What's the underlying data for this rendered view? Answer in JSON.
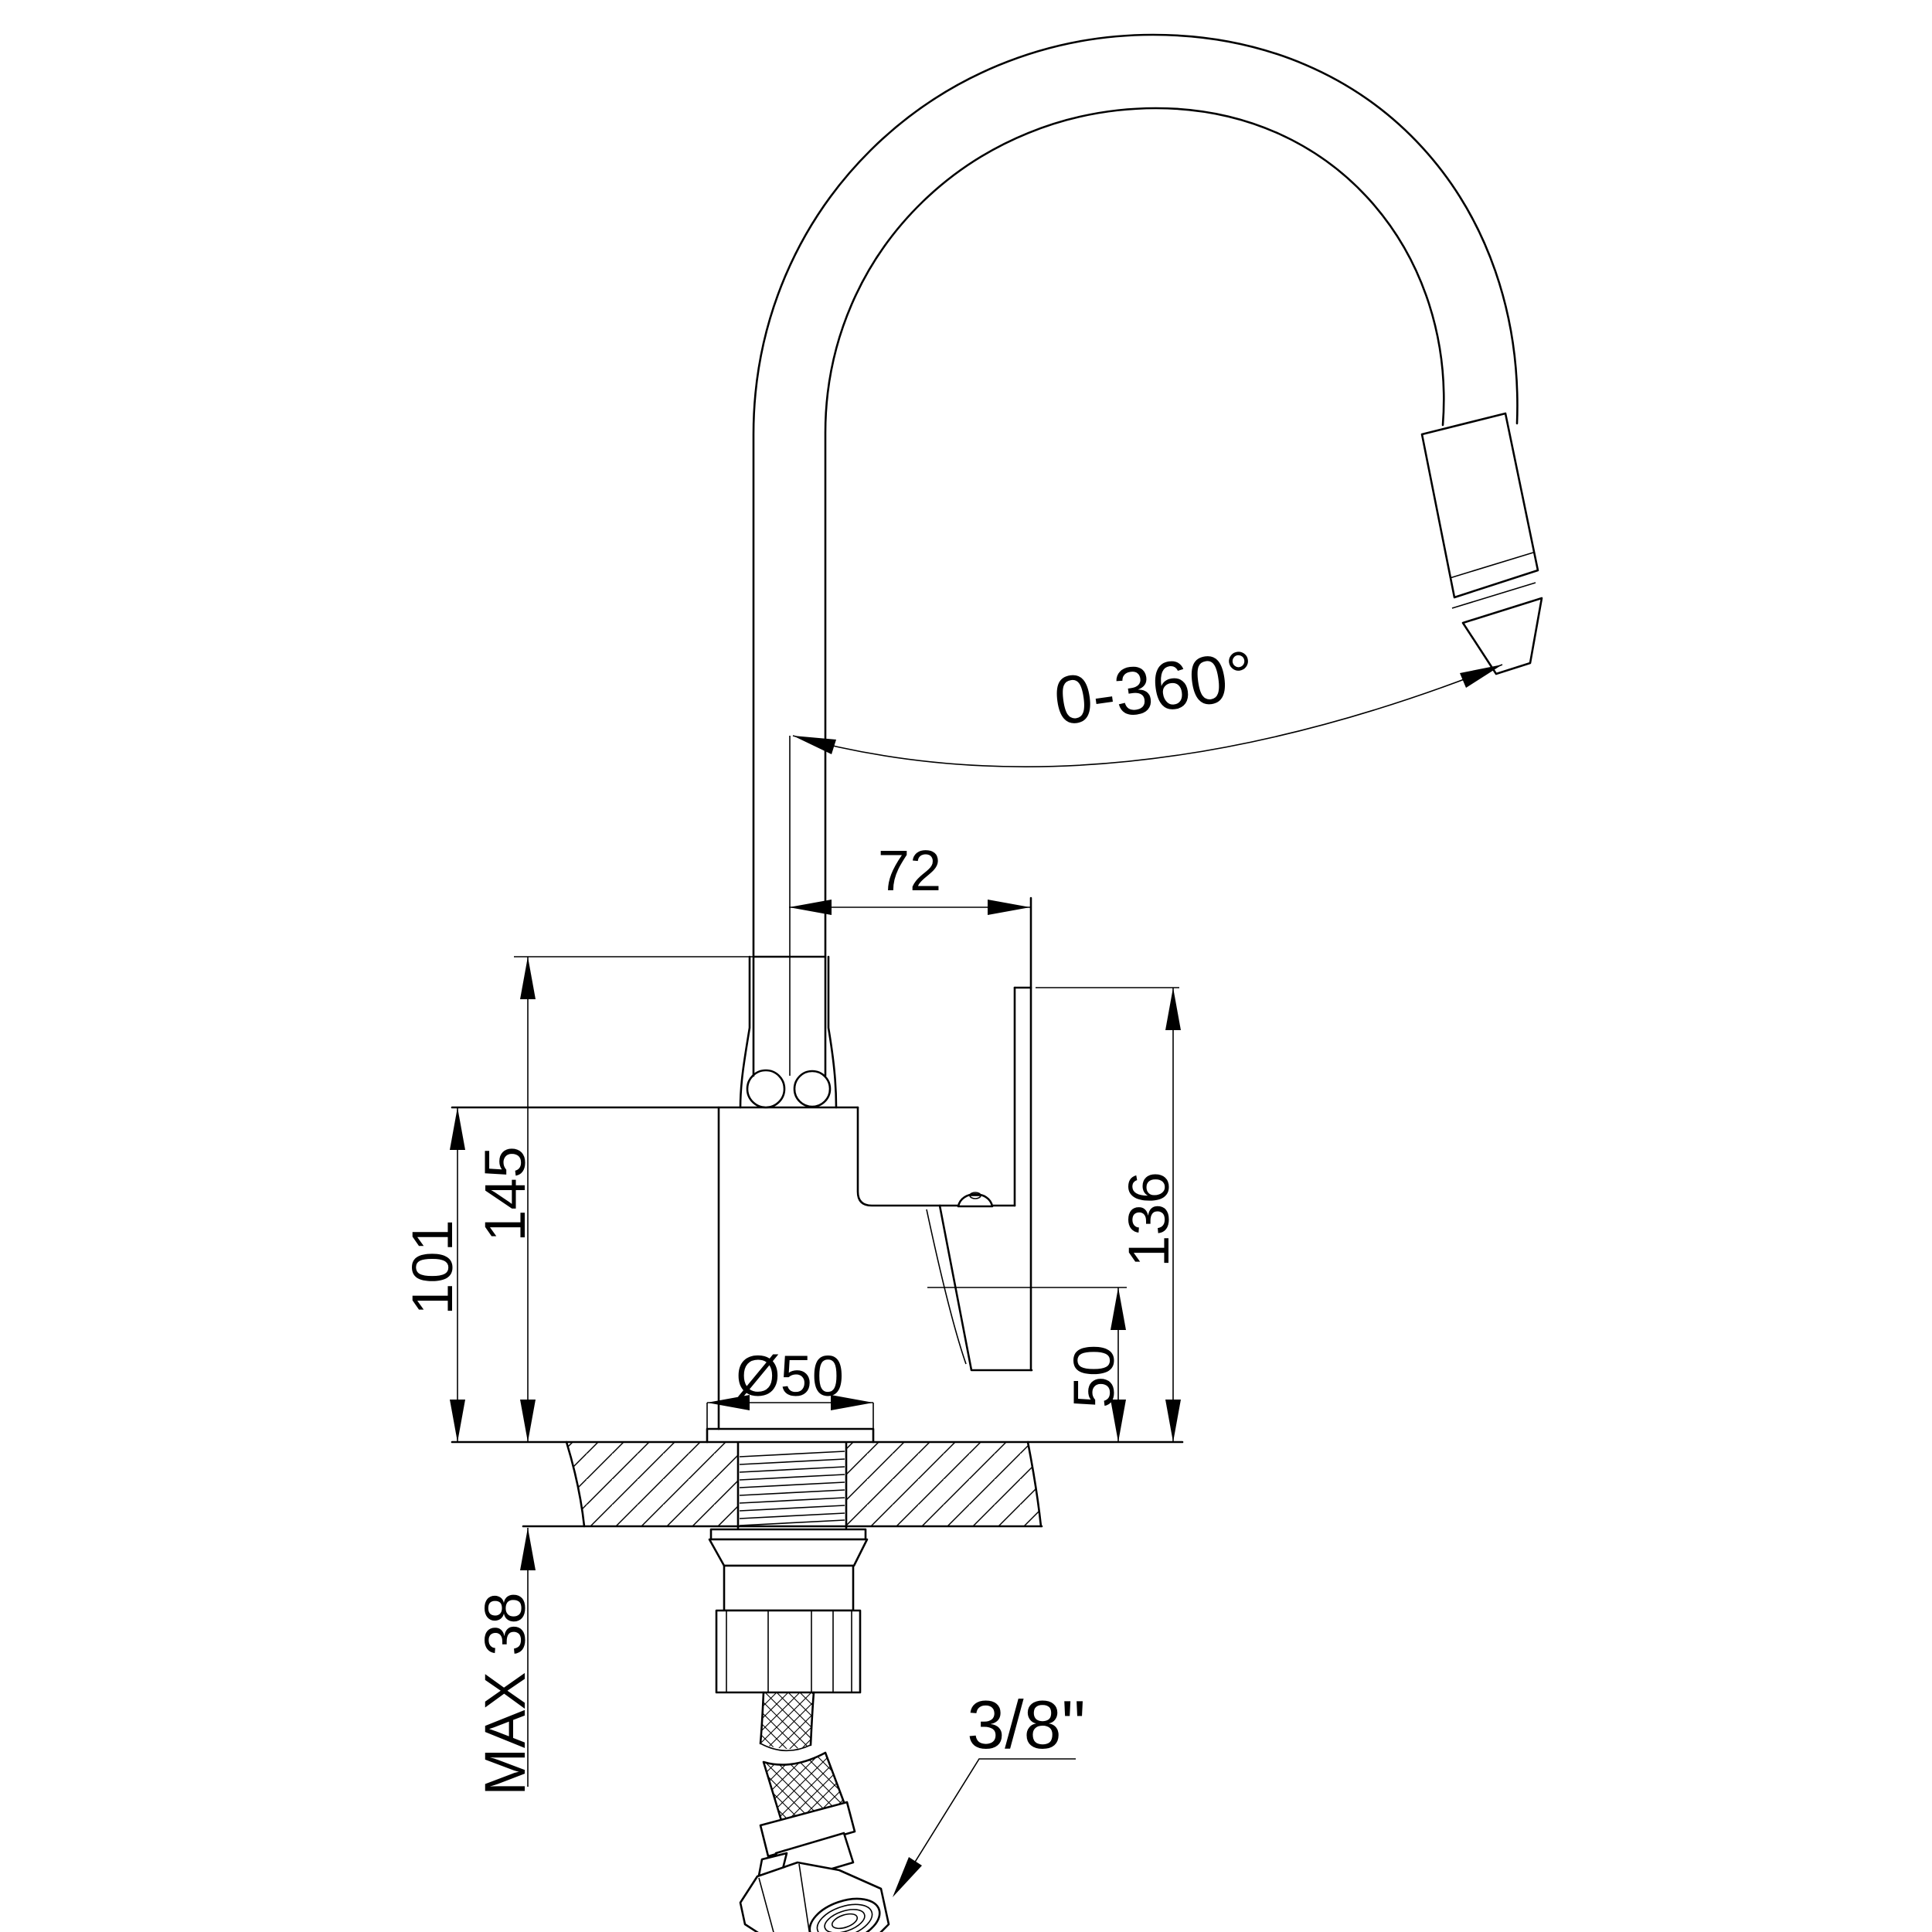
{
  "colors": {
    "line": "#000000",
    "background": "#ffffff"
  },
  "labels": {
    "rotation": "0-360°",
    "spout_offset": "72",
    "height_collar": "145",
    "height_body": "101",
    "height_handle": "136",
    "height_outlet": "50",
    "base_diameter": "Ø50",
    "max_deck": "MAX 38",
    "hose": "3/8\""
  }
}
